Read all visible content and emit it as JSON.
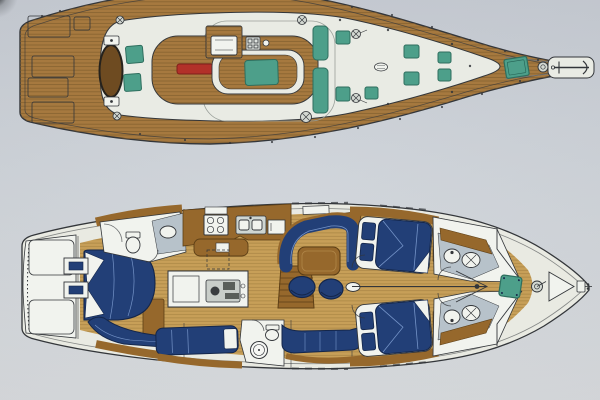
{
  "drawing": {
    "subject": "sailing-yacht-plan",
    "views": {
      "deck_plan": {
        "name": "deck-plan",
        "features": [
          "teak-deck",
          "aft-deck-hatches",
          "helm-oval",
          "cockpit-cushions",
          "cockpit-sole",
          "cockpit-table",
          "deck-saloon-island",
          "companionway-hatch",
          "instrument-panel",
          "side-seat-cushions",
          "coachroof-hatches",
          "winches",
          "dorade-vent",
          "fore-hatch",
          "windlass",
          "anchor-platform",
          "anchor"
        ]
      },
      "interior_plan": {
        "name": "interior-plan",
        "features": [
          "lazarette",
          "stern-ladder",
          "aft-cabin-berth",
          "aft-settee",
          "aft-head",
          "vanity-stool",
          "galley-stove",
          "galley-sink",
          "engine-room",
          "companionway-stairs",
          "pilot-berth",
          "mid-head",
          "saloon-settee-port",
          "saloon-table",
          "ottomans",
          "saloon-settee-starboard",
          "guest-cabin-port",
          "guest-cabin-starboard",
          "fwd-head-port",
          "fwd-head-starboard",
          "forepeak",
          "fore-hatch",
          "windlass",
          "anchor-locker",
          "bow-fitting"
        ]
      }
    }
  },
  "colors": {
    "paper_top": "#c5cad2",
    "paper_mid": "#cdd2d8",
    "paper_bottom": "#d7dadd",
    "outline": "#33363a",
    "teak": "#a6793f",
    "teak_line": "#7d5a2a",
    "teak_dark": "#6e4b21",
    "deck_white": "#e9ebe4",
    "teal": "#4d9f8a",
    "teal_dark": "#2e6e5e",
    "table_red": "#b23129",
    "navy": "#223f77",
    "navy_dark": "#14264a",
    "piping": "#7d9cd0",
    "hull_cream": "#e9eae2",
    "floor": "#c79f58",
    "floor_line": "#a07c3c",
    "wood": "#96682c",
    "wood_dark": "#5d3f16",
    "gray_fixture": "#b7c2ca",
    "white_fixture": "#f1f3ee",
    "metal": "#d3d8d2"
  }
}
